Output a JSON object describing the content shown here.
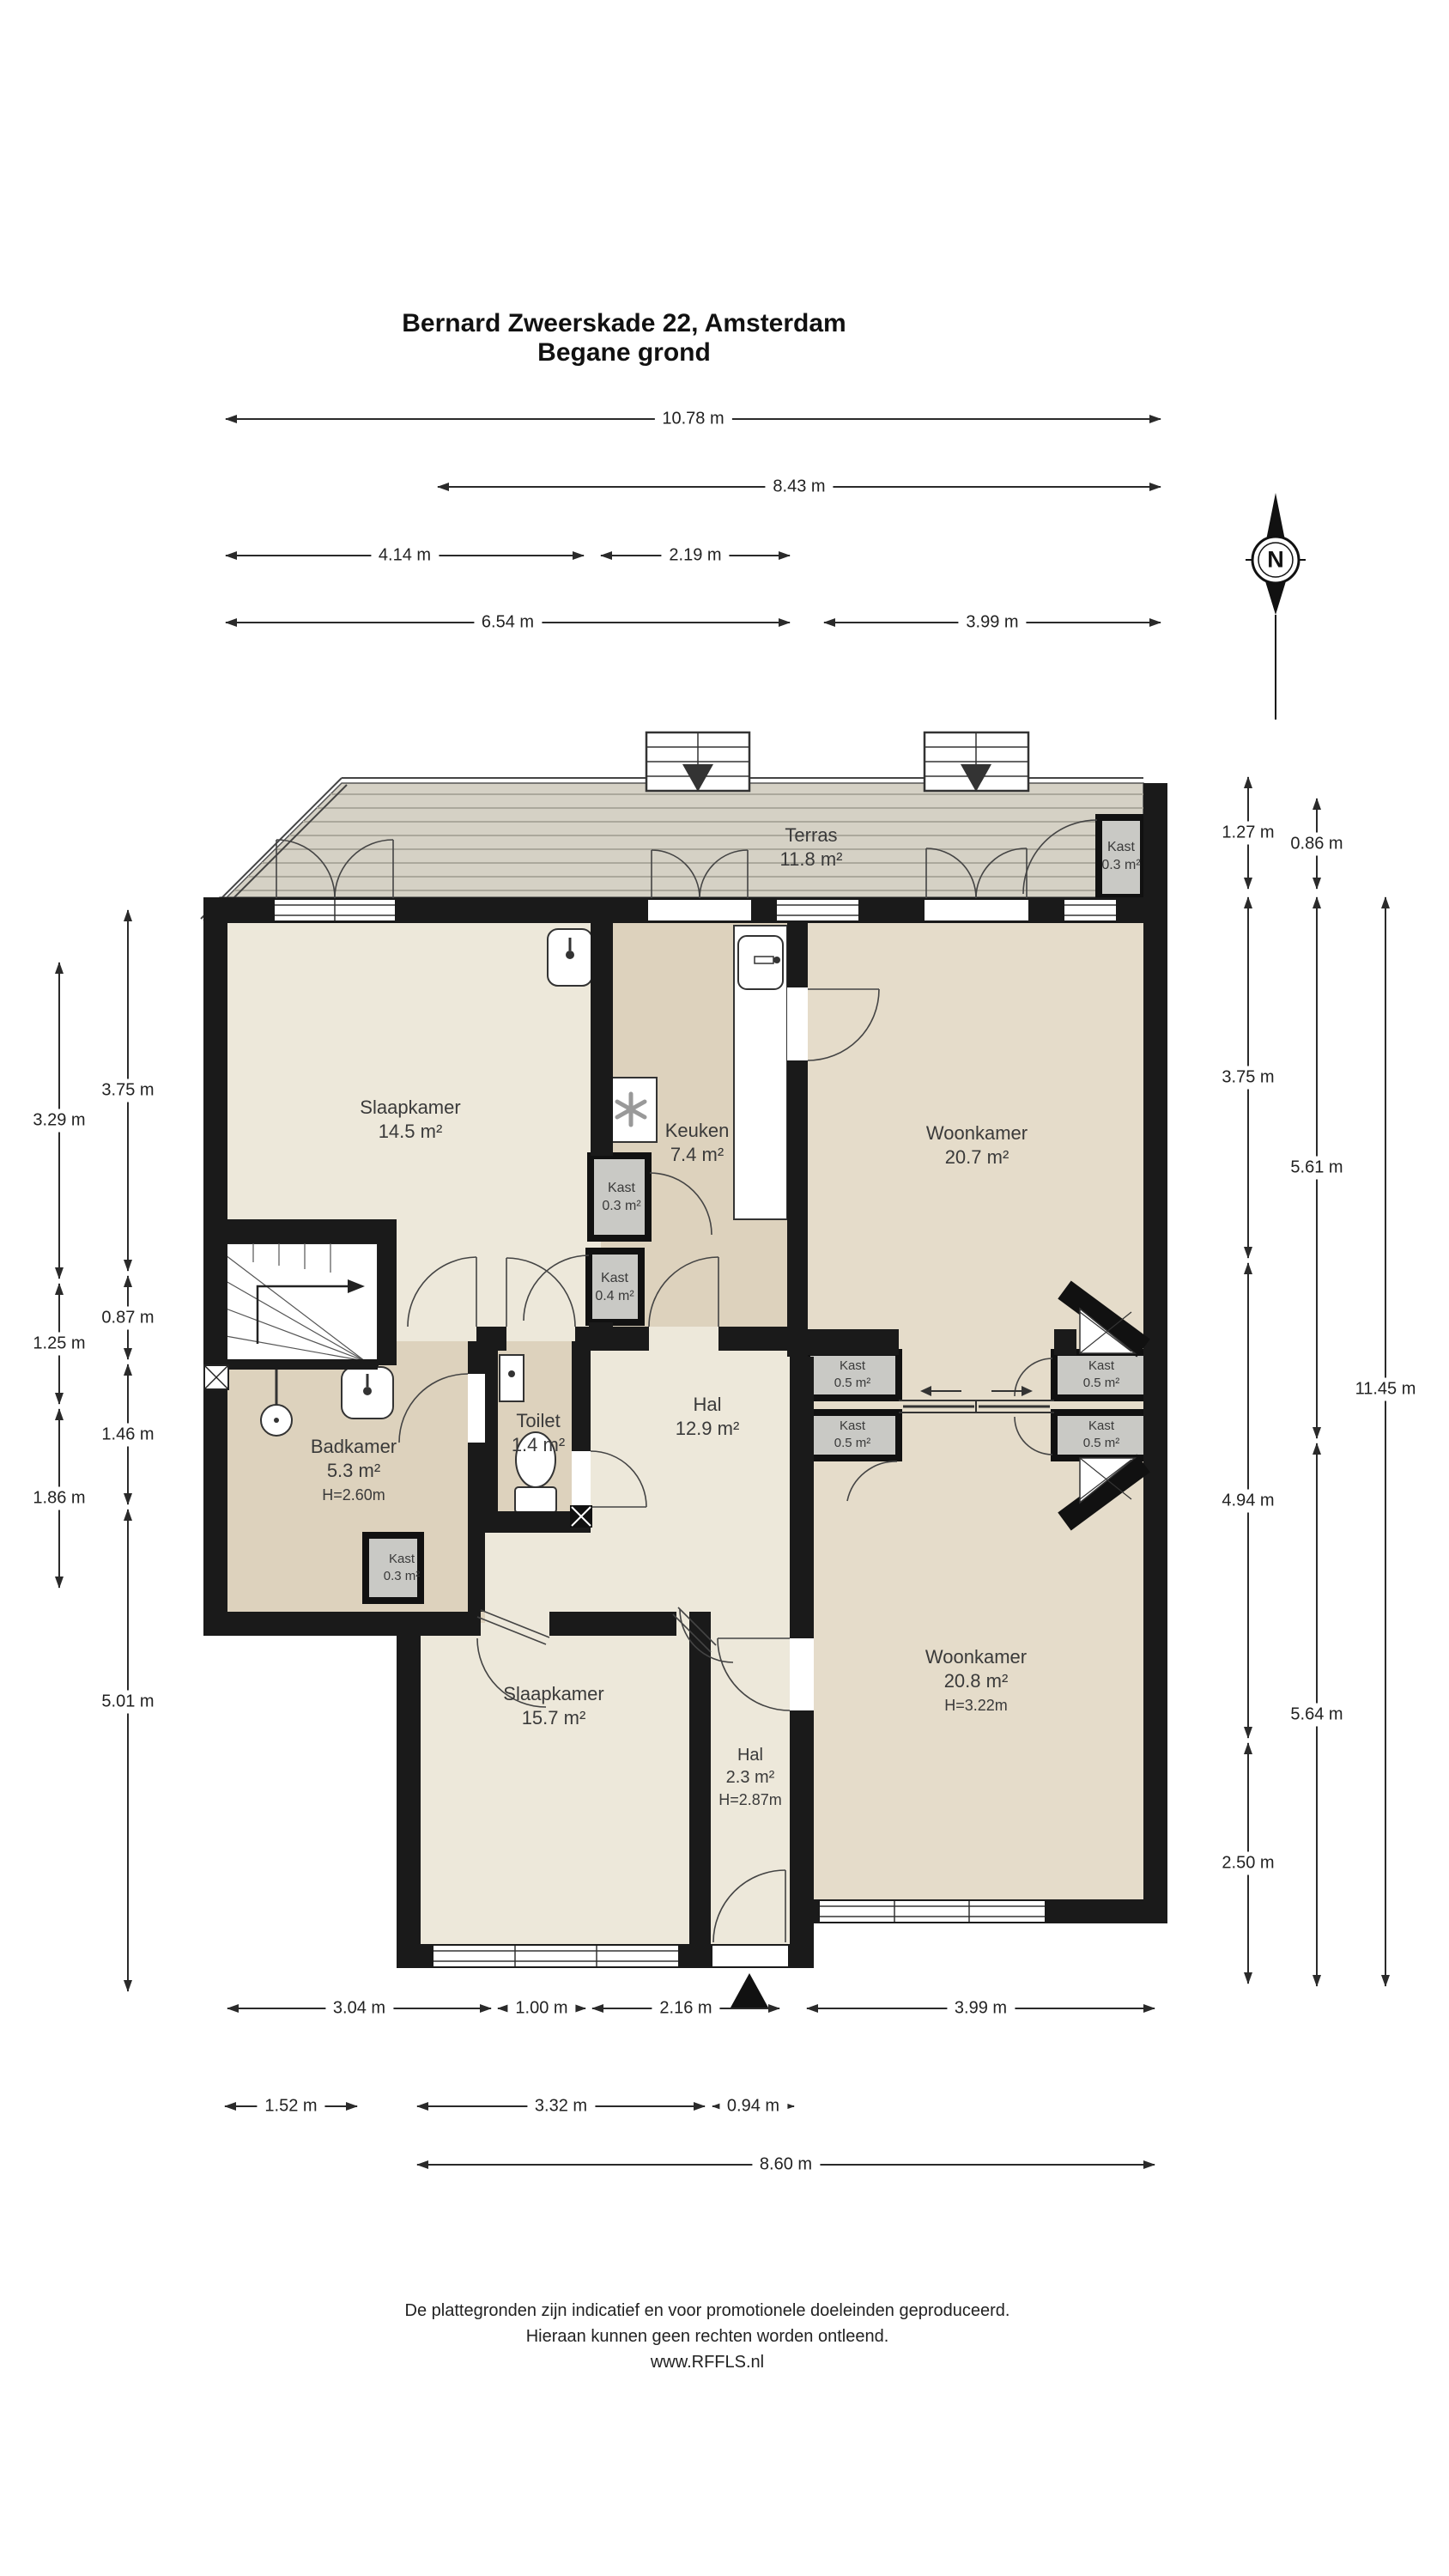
{
  "title": {
    "line1": "Bernard Zweerskade 22, Amsterdam",
    "line2": "Begane grond"
  },
  "compass": {
    "label": "N"
  },
  "dims": {
    "top": [
      "10.78 m",
      "8.43 m",
      "4.14 m",
      "2.19 m",
      "6.54 m",
      "3.99 m"
    ],
    "left_outer": [
      "3.29 m",
      "1.25 m",
      "1.86 m"
    ],
    "left_inner": [
      "3.75 m",
      "0.87 m",
      "1.46 m",
      "5.01 m"
    ],
    "right_inner": [
      "1.27 m",
      "3.75 m",
      "4.94 m",
      "2.50 m"
    ],
    "right_mid": [
      "0.86 m",
      "5.61 m",
      "5.64 m"
    ],
    "right_outer": [
      "11.45 m"
    ],
    "bottom_row1": [
      "3.04 m",
      "1.00 m",
      "2.16 m",
      "3.99 m"
    ],
    "bottom_row2": [
      "1.52 m",
      "3.32 m",
      "0.94 m"
    ],
    "bottom_row3": [
      "8.60 m"
    ]
  },
  "rooms": {
    "terras": {
      "name": "Terras",
      "area": "11.8 m²"
    },
    "kast_terras": {
      "name": "Kast",
      "area": "0.3 m²"
    },
    "slaapkamer1": {
      "name": "Slaapkamer",
      "area": "14.5 m²"
    },
    "keuken": {
      "name": "Keuken",
      "area": "7.4 m²"
    },
    "woonkamer1": {
      "name": "Woonkamer",
      "area": "20.7 m²"
    },
    "kast_keuken": {
      "name": "Kast",
      "area": "0.3 m²"
    },
    "kast_hal": {
      "name": "Kast",
      "area": "0.4 m²"
    },
    "badkamer": {
      "name": "Badkamer",
      "area": "5.3 m²",
      "height": "H=2.60m"
    },
    "toilet": {
      "name": "Toilet",
      "area": "1.4 m²"
    },
    "hal1": {
      "name": "Hal",
      "area": "12.9 m²"
    },
    "kast_a": {
      "name": "Kast",
      "area": "0.5 m²"
    },
    "kast_b": {
      "name": "Kast",
      "area": "0.5 m²"
    },
    "kast_c": {
      "name": "Kast",
      "area": "0.5 m²"
    },
    "kast_d": {
      "name": "Kast",
      "area": "0.5 m²"
    },
    "kast_badkamer": {
      "name": "Kast",
      "area": "0.3 m²"
    },
    "slaapkamer2": {
      "name": "Slaapkamer",
      "area": "15.7 m²"
    },
    "woonkamer2": {
      "name": "Woonkamer",
      "area": "20.8 m²",
      "height": "H=3.22m"
    },
    "hal2": {
      "name": "Hal",
      "area": "2.3 m²",
      "height": "H=2.87m"
    }
  },
  "footer": {
    "line1": "De plattegronden zijn indicatief en voor promotionele doeleinden geproduceerd.",
    "line2": "Hieraan kunnen geen rechten worden ontleend.",
    "line3": "www.RFFLS.nl"
  },
  "colors": {
    "wall": "#1a1a1a",
    "room_light": "#EDE8DA",
    "room_tan": "#DDD2BD",
    "room_living": "#E5DCCA",
    "closet": "#C9C9C5",
    "terrace": "#D5D1C5"
  }
}
